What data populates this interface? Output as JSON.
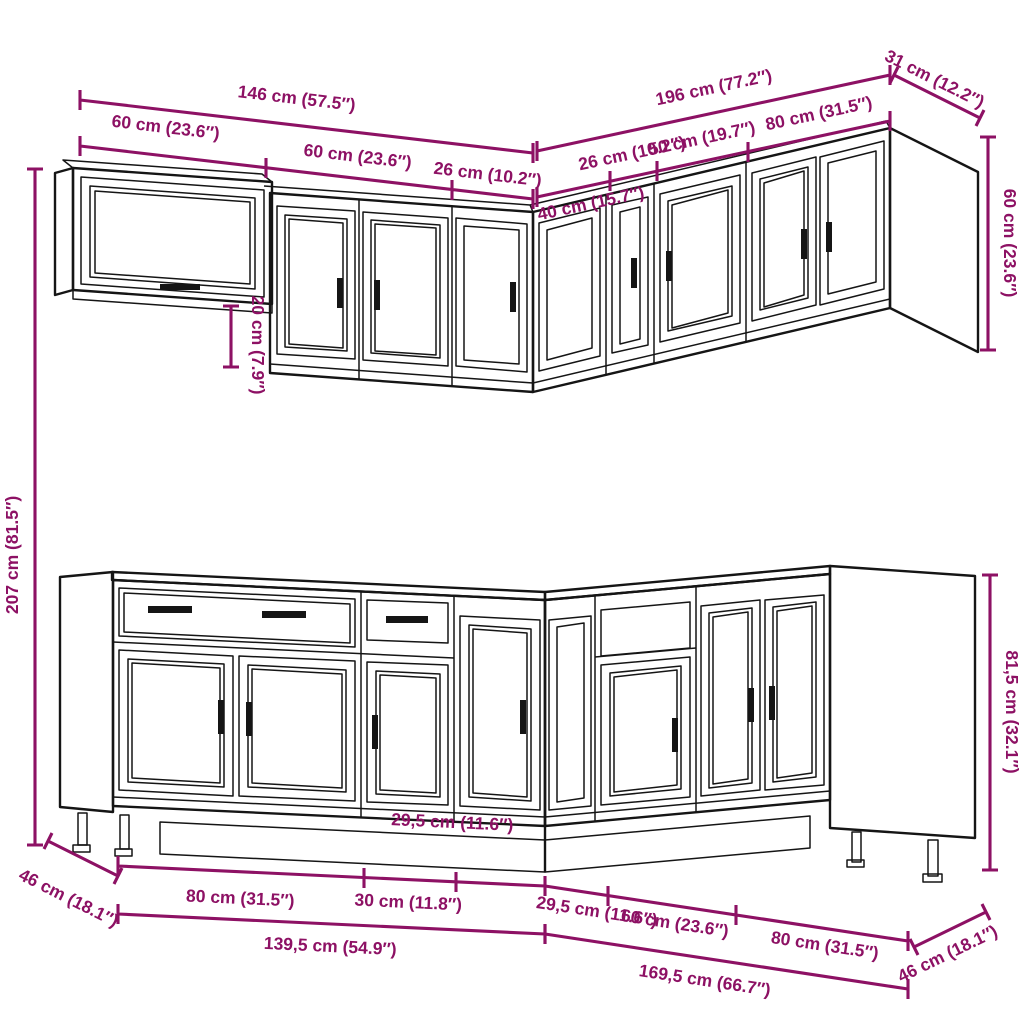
{
  "colors": {
    "accent": "#8D1164",
    "line": "#151515",
    "background": "#FFFFFF"
  },
  "dimensions": {
    "wall_run": {
      "total_left": "146 cm (57.5″)",
      "total_right": "196 cm (77.2″)",
      "right_depth": "31 cm (12.2″)",
      "left_segments": [
        "60 cm (23.6″)",
        "60 cm (23.6″)",
        "26 cm (10.2″)"
      ],
      "right_segments": [
        "26 cm (10.2″)",
        "50 cm (19.7″)",
        "80 cm (31.5″)"
      ],
      "corner_width": "40 cm (15.7″)",
      "cabinet_height": "60 cm (23.6″)",
      "hang_offset": "20 cm (7.9″)",
      "total_height": "207 cm (81.5″)"
    },
    "base_run": {
      "left_segments": [
        "80 cm (31.5″)",
        "30 cm (11.8″)"
      ],
      "corner_left": "29,5 cm (11.6″)",
      "right_segments": [
        "29,5 cm (11.6″)",
        "60 cm (23.6″)",
        "80 cm (31.5″)"
      ],
      "total_left": "139,5 cm (54.9″)",
      "total_right": "169,5 cm (66.7″)",
      "left_depth": "46 cm (18.1″)",
      "right_depth": "46 cm (18.1″)",
      "cabinet_height": "81,5 cm (32.1″)"
    }
  }
}
